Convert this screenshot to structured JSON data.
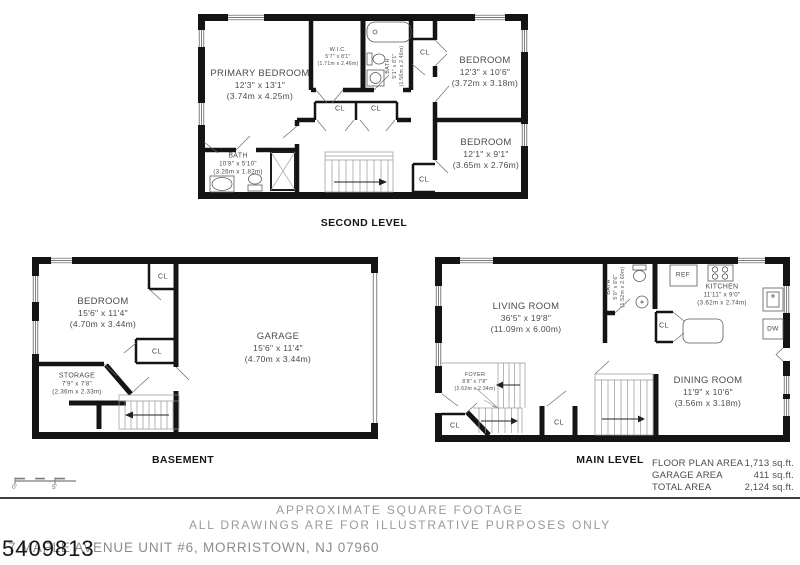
{
  "sheet": {
    "scale_bar": {
      "zero": "0'",
      "five": "5'"
    },
    "disclaimer_line1": "APPROXIMATE SQUARE FOOTAGE",
    "disclaimer_line2": "ALL DRAWINGS ARE FOR ILLUSTRATIVE PURPOSES ONLY",
    "address": "7 MAPLE AVENUE UNIT #6, MORRISTOWN, NJ 07960",
    "watermark": "5409813"
  },
  "labels": {
    "closet": "CL",
    "fridge": "REF",
    "dishwasher": "DW"
  },
  "areas": {
    "floor_plan": {
      "label": "FLOOR PLAN AREA",
      "value": "1,713 sq.ft."
    },
    "garage": {
      "label": "GARAGE AREA",
      "value": "411 sq.ft."
    },
    "total": {
      "label": "TOTAL AREA",
      "value": "2,124 sq.ft."
    }
  },
  "levels": {
    "second": {
      "title": "SECOND LEVEL",
      "rooms": {
        "primary_bedroom": {
          "name": "PRIMARY BEDROOM",
          "dim_ft": "12'3\" x 13'1\"",
          "dim_m": "(3.74m x 4.25m)"
        },
        "wic": {
          "name": "W.I.C.",
          "dim_ft": "5'7\" x 8'1\"",
          "dim_m": "(1.71m x 2.46m)"
        },
        "bath": {
          "name": "BATH",
          "dim_ft": "5'1\" x 8'1\"",
          "dim_m": "(1.56m x 2.46m)"
        },
        "bedroom_ne": {
          "name": "BEDROOM",
          "dim_ft": "12'3\" x 10'6\"",
          "dim_m": "(3.72m x 3.18m)"
        },
        "bedroom_se": {
          "name": "BEDROOM",
          "dim_ft": "12'1\" x 9'1\"",
          "dim_m": "(3.65m x 2.76m)"
        },
        "bath_sw": {
          "name": "BATH",
          "dim_ft": "10'8\" x 5'10\"",
          "dim_m": "(3.26m x 1.82m)"
        }
      }
    },
    "basement": {
      "title": "BASEMENT",
      "rooms": {
        "bedroom": {
          "name": "BEDROOM",
          "dim_ft": "15'6\" x 11'4\"",
          "dim_m": "(4.70m x 3.44m)"
        },
        "garage": {
          "name": "GARAGE",
          "dim_ft": "15'6\" x 11'4\"",
          "dim_m": "(4.70m x 3.44m)"
        },
        "storage": {
          "name": "STORAGE",
          "dim_ft": "7'9\" x 7'8\"",
          "dim_m": "(2.36m x 2.33m)"
        }
      }
    },
    "main": {
      "title": "MAIN LEVEL",
      "rooms": {
        "living_room": {
          "name": "LIVING ROOM",
          "dim_ft": "36'5\" x 19'8\"",
          "dim_m": "(11.09m x 6.00m)"
        },
        "bath": {
          "name": "BATH",
          "dim_ft": "5'0\" x 8'6\"",
          "dim_m": "(1.52m x 2.60m)"
        },
        "kitchen": {
          "name": "KITCHEN",
          "dim_ft": "11'11\" x 9'0\"",
          "dim_m": "(3.62m x 2.74m)"
        },
        "dining_room": {
          "name": "DINING ROOM",
          "dim_ft": "11'9\" x 10'6\"",
          "dim_m": "(3.56m x 3.18m)"
        },
        "foyer": {
          "name": "FOYER",
          "dim_ft": "8'8\" x 7'8\"",
          "dim_m": "(2.62m x 2.34m)"
        }
      }
    }
  },
  "colors": {
    "wall": "#141414",
    "room_text": "#4b4b4b",
    "muted_text": "#9a9a9a"
  }
}
